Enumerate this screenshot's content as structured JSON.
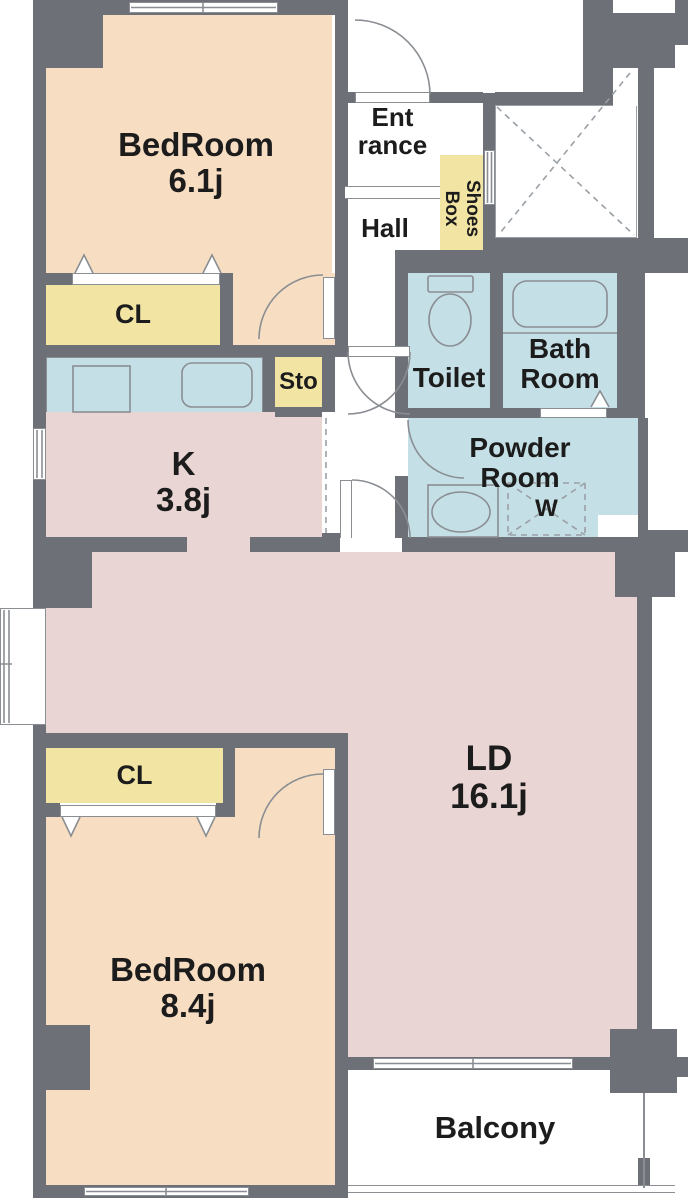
{
  "plan_title": "2LDK apartment floor plan",
  "colors": {
    "wall": "#6d7076",
    "bedroom_fill": "#f7dec2",
    "closet_fill": "#f2e5a4",
    "wet_area_fill": "#c4dfe5",
    "living_kitchen_fill": "#e9d6d4",
    "outline": "#8a8e93",
    "text": "#1c1c1c",
    "background": "#ffffff"
  },
  "rooms": {
    "bedroom1": {
      "name": "BedRoom",
      "area": "6.1j"
    },
    "closet1": {
      "label": "CL"
    },
    "storage": {
      "label": "Sto"
    },
    "entrance": {
      "line1": "Ent",
      "line2": "rance"
    },
    "hall": {
      "label": "Hall"
    },
    "shoes_box": {
      "label": "Shoes\nBox"
    },
    "toilet": {
      "label": "Toilet"
    },
    "bathroom": {
      "line1": "Bath",
      "line2": "Room"
    },
    "powder_room": {
      "line1": "Powder",
      "line2": "Room"
    },
    "washer": {
      "label": "W"
    },
    "kitchen": {
      "name": "K",
      "area": "3.8j"
    },
    "living_dining": {
      "name": "LD",
      "area": "16.1j"
    },
    "closet2": {
      "label": "CL"
    },
    "bedroom2": {
      "name": "BedRoom",
      "area": "8.4j"
    },
    "balcony": {
      "label": "Balcony"
    }
  }
}
